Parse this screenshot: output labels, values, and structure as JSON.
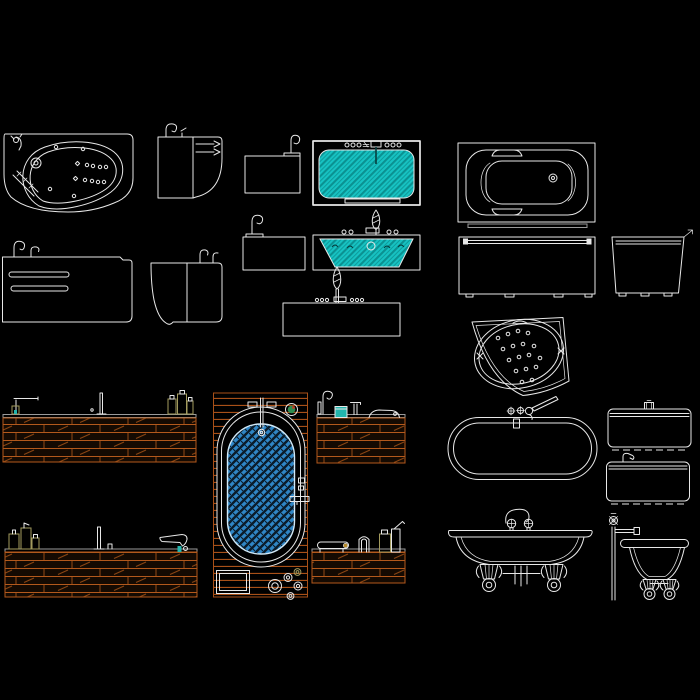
{
  "canvas": {
    "kind": "cad-linework",
    "width": 700,
    "height": 700
  },
  "colors": {
    "background": "#000000",
    "line": "#e8e8e8",
    "line_dim": "#9a9a9a",
    "cyan_fill": "#17c2c2",
    "cyan_dark": "#0a9191",
    "cyan_ink": "#063d3d",
    "blue_fill": "#2f86c6",
    "blue_dark": "#0a1c2a",
    "wood_line": "#b3591c",
    "wood_grain": "#8a4513",
    "wood_bg": "#140a02",
    "deck_line": "#a85018",
    "olive": "#a39b5e",
    "teal": "#23b5ad",
    "green": "#2e8b4f",
    "red": "#c23b2a",
    "ochre": "#b58a2a"
  },
  "fixtures": [
    {
      "id": "corner-whirlpool-plan",
      "label": "Corner whirlpool bathtub with jets - plan view"
    },
    {
      "id": "washbasin-side",
      "label": "Washbasin with jets - side view"
    },
    {
      "id": "tub-panel-spout-1",
      "label": "Tub side panel with gooseneck spout"
    },
    {
      "id": "whirlpool-tub-plan",
      "label": "Whirlpool bathtub filled with water - top view"
    },
    {
      "id": "bathtub-plan",
      "label": "Bathtub with grab rails - plan view"
    },
    {
      "id": "tub-side-elevation",
      "label": "Bathtub side elevation with spouts and overflow slots"
    },
    {
      "id": "tub-end-elevation",
      "label": "Bathtub end elevation with spouts"
    },
    {
      "id": "tub-panel-spout-2",
      "label": "Tub side panel with gooseneck spout"
    },
    {
      "id": "whirlpool-section",
      "label": "Whirlpool bathtub cross-section with hand shower"
    },
    {
      "id": "tub-elevation-shower",
      "label": "Bathtub elevation with hand shower"
    },
    {
      "id": "tub-front-elevation",
      "label": "Bathtub front elevation on feet"
    },
    {
      "id": "tub-end-elevation-2",
      "label": "Bathtub end elevation on feet"
    },
    {
      "id": "corner-airjet-plan",
      "label": "Corner air-jet bathtub - plan view"
    },
    {
      "id": "deck-counter-1",
      "label": "Wood tub deck elevation with faucet and bottles"
    },
    {
      "id": "deck-tub-plan",
      "label": "Deck-mounted oval bathtub - top view"
    },
    {
      "id": "deck-counter-2",
      "label": "Wood tub deck elevation with faucet and jar"
    },
    {
      "id": "oval-tub-plan",
      "label": "Oval bathtub with cross-handle faucet - plan view"
    },
    {
      "id": "tub-side-elev-a",
      "label": "Bathtub side elevation with top knob"
    },
    {
      "id": "tub-side-elev-b",
      "label": "Bathtub side elevation with spout"
    },
    {
      "id": "deck-counter-3",
      "label": "Wood tub deck elevation with bottles and spout"
    },
    {
      "id": "deck-counter-4",
      "label": "Wood tub deck elevation with accessories"
    },
    {
      "id": "clawfoot-front",
      "label": "Clawfoot bathtub front elevation with faucet"
    },
    {
      "id": "clawfoot-end",
      "label": "Clawfoot bathtub end elevation with shower riser"
    }
  ]
}
